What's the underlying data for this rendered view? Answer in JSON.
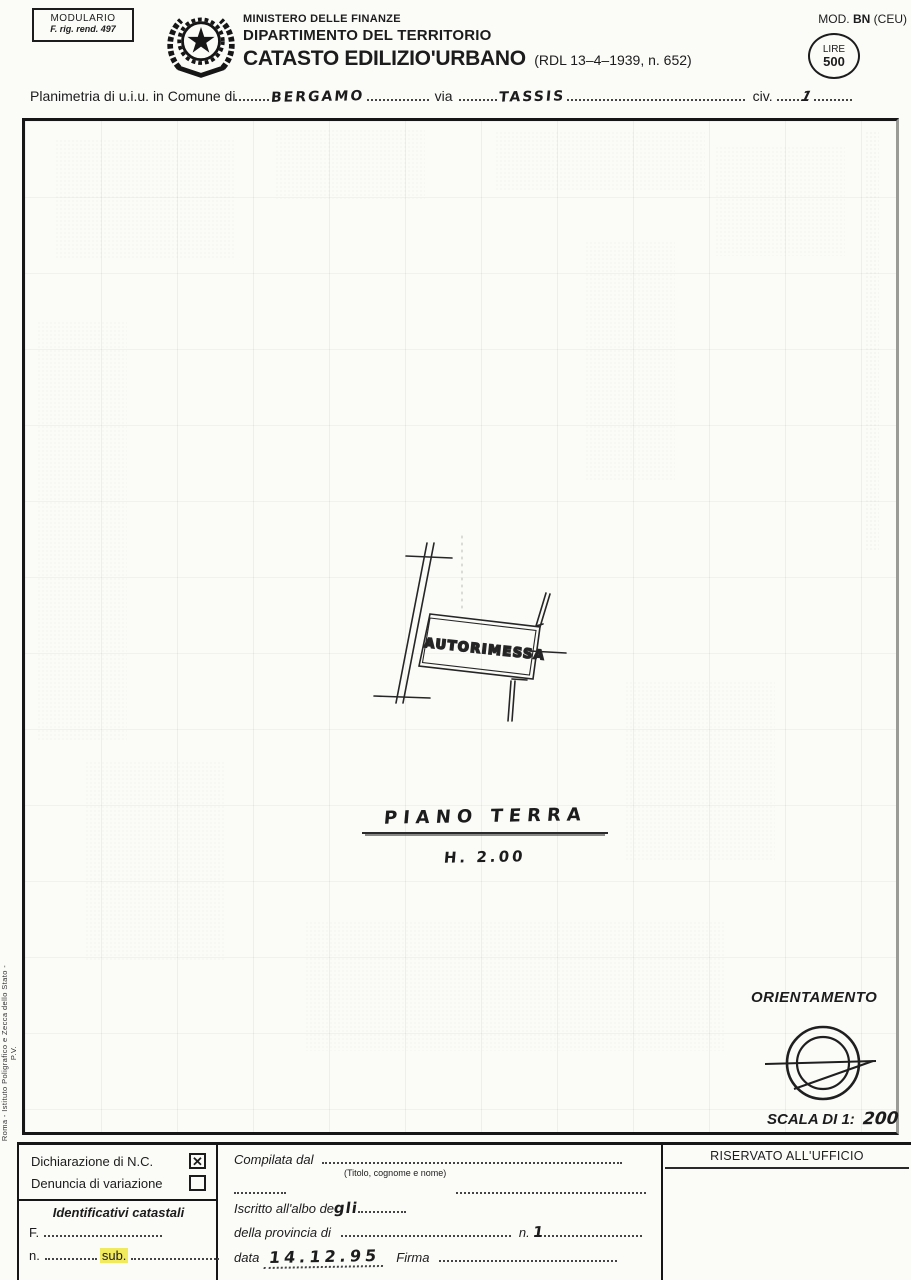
{
  "colors": {
    "ink": "#1c1c1c",
    "paper": "#fbfbf8",
    "highlight": "#f1e95e"
  },
  "stamp": {
    "line1": "MODULARIO",
    "line2": "F. rig. rend. 497"
  },
  "header": {
    "ministry": "MINISTERO DELLE FINANZE",
    "department": "DIPARTIMENTO DEL TERRITORIO",
    "title": "CATASTO EDILIZIO'URBANO",
    "law": "(RDL 13–4–1939, n. 652)",
    "mod_prefix": "MOD.",
    "mod_code": "BN",
    "mod_suffix": "(CEU)",
    "lire_label": "LIRE",
    "lire_value": "500"
  },
  "subject": {
    "label": "Planimetria di u.i.u. in Comune di",
    "comune": "BERGAMO",
    "via_label": "via",
    "via": "TASSIS",
    "civ_label": "civ.",
    "civ": "1"
  },
  "plan": {
    "room": "AUTORIMESSA",
    "floor": "PIANO TERRA",
    "height": "H. 2.00",
    "orientation": "ORIENTAMENTO",
    "scale_label": "SCALA DI 1:",
    "scale_value": "200"
  },
  "sidenote": "Roma - Istituto Poligrafico e Zecca dello Stato - P.V.",
  "footer": {
    "declaration": {
      "option1_label": "Dichiarazione di N.C.",
      "option1_mark": "✕",
      "option2_label": "Denuncia di variazione",
      "option2_mark": ""
    },
    "identifiers": {
      "title": "Identificativi catastali",
      "f_label": "F.",
      "n_label": "n.",
      "sub_label": "sub."
    },
    "compiler": {
      "compiled_label": "Compilata dal",
      "hint": "(Titolo, cognome e nome)",
      "albo_label": "Iscritto all'albo de",
      "albo_value": "gli",
      "provincia_label": "della provincia di",
      "n_label": "n.",
      "n_value": "1",
      "data_label": "data",
      "data_value": "14.12.95",
      "firma_label": "Firma"
    },
    "office": {
      "title": "RISERVATO ALL'UFFICIO"
    }
  }
}
